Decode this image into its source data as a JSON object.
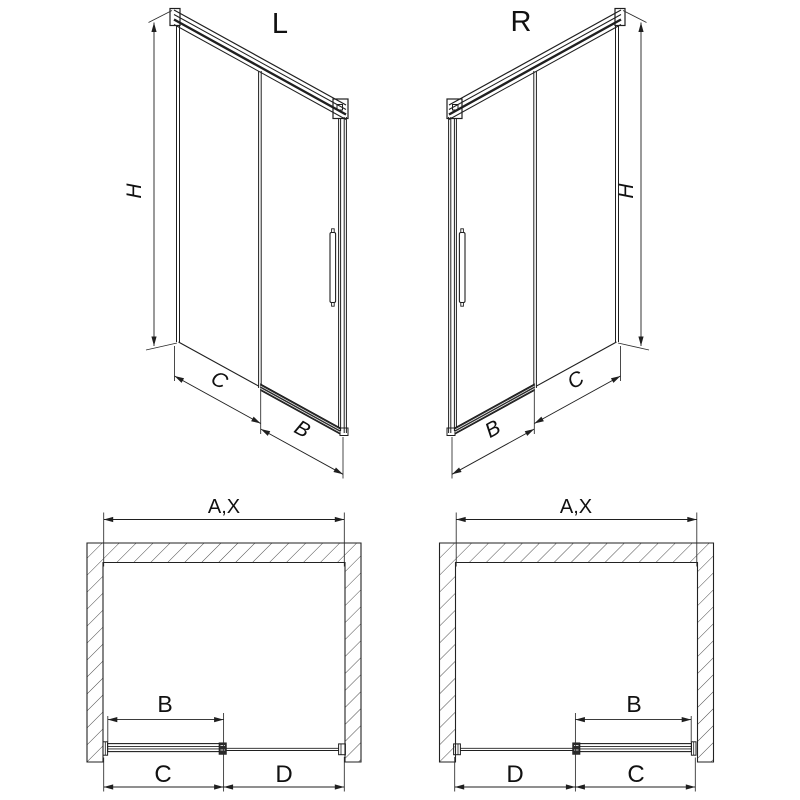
{
  "page": {
    "background_color": "#ffffff",
    "line_color": "#1f1f1f",
    "description_labels_only": true
  },
  "views": {
    "isometric_left": {
      "title": "L",
      "height_label": "H",
      "fixed_segment_label": "C",
      "door_segment_label": "B"
    },
    "isometric_right": {
      "title": "R",
      "height_label": "H",
      "fixed_segment_label": "C",
      "door_segment_label": "B"
    },
    "plan_left": {
      "opening_width_label": "A,X",
      "door_width_label": "B",
      "segment_c_label": "C",
      "segment_d_label": "D"
    },
    "plan_right": {
      "opening_width_label": "A,X",
      "door_width_label": "B",
      "segment_c_label": "C",
      "segment_d_label": "D"
    }
  }
}
